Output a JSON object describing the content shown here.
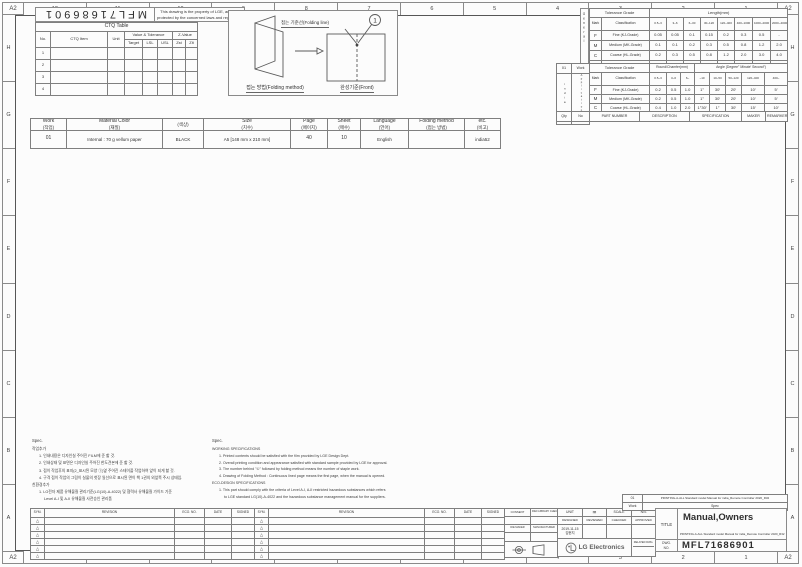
{
  "grid": {
    "corner_label": "A2",
    "top_columns": [
      "12",
      "11",
      "10",
      "9",
      "8",
      "7",
      "6",
      "5",
      "4",
      "3",
      "2",
      "1"
    ],
    "bottom_columns": [
      "12",
      "11",
      "10",
      "9",
      "8",
      "7",
      "6",
      "5",
      "4",
      "3",
      "2",
      "1"
    ],
    "left_rows": [
      "H",
      "G",
      "F",
      "E",
      "D",
      "C",
      "B",
      "A"
    ],
    "right_rows": [
      "H",
      "G",
      "F",
      "E",
      "D",
      "C",
      "B",
      "A"
    ]
  },
  "top_left": {
    "doc_number_rotated": "MFL71686901",
    "notice_line1": "This drawing is the property of LGE, and it is",
    "notice_line2": "protected by the concerned laws and regulation.",
    "ctq": {
      "title": "CTQ Table",
      "col_no": "No.",
      "col_item": "CTQ Item",
      "col_unit": "Unit",
      "col_vt": "Value & Tolerance",
      "col_z": "Z-Value",
      "sub_target": "Target",
      "sub_lsl": "LSL",
      "sub_usl": "USL",
      "sub_zst": "Zst",
      "sub_zlt": "Zlt",
      "rows": [
        "1",
        "2",
        "3",
        "4"
      ]
    }
  },
  "folding": {
    "line_label": "접는 기준선(Folding line)",
    "method_label": "접는 방법(Folding method)",
    "front_label": "완성기준(Front)",
    "callout": "1"
  },
  "tolerance": {
    "side_label_1": "General",
    "side_label_2": "Tolerance",
    "grade_header": "Tolerance Grade",
    "mark_header": "Mark",
    "class_header": "Classification",
    "length": {
      "header": "Length(mm)",
      "cols": [
        "0.5~3",
        "3~6",
        "6~30",
        "30~120",
        "120~400",
        "400~1000",
        "1000~2000",
        "2000~4000"
      ],
      "rows": [
        {
          "mark": "F",
          "name": "Fine (KJ-Grade)",
          "v": [
            "0.05",
            "0.05",
            "0.1",
            "0.15",
            "0.2",
            "0.3",
            "0.5",
            "-"
          ]
        },
        {
          "mark": "M",
          "name": "Medium (MK-Grade)",
          "v": [
            "0.1",
            "0.1",
            "0.2",
            "0.3",
            "0.5",
            "0.8",
            "1.2",
            "2.0"
          ]
        },
        {
          "mark": "C",
          "name": "Coarse (HL-Grade)",
          "v": [
            "0.2",
            "0.3",
            "0.5",
            "0.8",
            "1.2",
            "2.0",
            "3.0",
            "4.0"
          ]
        },
        {
          "mark": "Ⓥ",
          "name": "Very Coarse (HW-Grade)",
          "v": [
            "-",
            "0.5",
            "1.0",
            "1.5",
            "2.5",
            "4.0",
            "6.0",
            "8.0"
          ]
        }
      ]
    },
    "angle": {
      "header_round": "Round/Chamfer(mm)",
      "header_angle": "Angle (Degree° Minute′ Second″)",
      "cols": [
        "0.5~3",
        "3~6",
        "6~",
        "~10",
        "10~50",
        "50~120",
        "120~400",
        "400~"
      ],
      "rows": [
        {
          "mark": "F",
          "name": "Fine (KJ-Grade)",
          "v": [
            "0.2",
            "0.5",
            "1.0",
            "1°",
            "30′",
            "20′",
            "10′",
            "5′"
          ]
        },
        {
          "mark": "M",
          "name": "Medium (MK-Grade)",
          "v": [
            "0.2",
            "0.5",
            "1.0",
            "1°",
            "30′",
            "20′",
            "10′",
            "5′"
          ]
        },
        {
          "mark": "C",
          "name": "Coarse (HL-Grade)",
          "v": [
            "0.4",
            "1.0",
            "2.0",
            "1°30′",
            "1°",
            "30′",
            "15′",
            "10′"
          ]
        },
        {
          "mark": "Ⓥ",
          "name": "Very Coarse (HW-Grade)",
          "v": [
            "0.4",
            "1.0",
            "2.0",
            "3°",
            "2°",
            "1°",
            "30′",
            "20′"
          ]
        }
      ]
    },
    "side_boxes": {
      "work_no": "01",
      "work_label": "Work",
      "app_value": "india",
      "app_label": "Application",
      "site_value": "CW",
      "site_label": "Site",
      "qty_label": "Qty"
    },
    "parts_header": {
      "no": "No",
      "part_number": "PART NUMBER",
      "description": "DESCRIPTION",
      "specification": "SPECIFICATION",
      "maker": "MAKER",
      "remarker": "REMARKER"
    }
  },
  "work_table": {
    "cols": [
      {
        "label": "Work",
        "sub": "(작업)"
      },
      {
        "label": "Material Color",
        "sub": "(재질)"
      },
      {
        "label": "",
        "sub": "(색상)"
      },
      {
        "label": "Size",
        "sub": "(치수)"
      },
      {
        "label": "Page",
        "sub": "(페이지)"
      },
      {
        "label": "Sheet",
        "sub": "(매수)"
      },
      {
        "label": "Language",
        "sub": "(언어)"
      },
      {
        "label": "Folding method",
        "sub": "(접는 방법)"
      },
      {
        "label": "etc.",
        "sub": "(비고)"
      }
    ],
    "row": {
      "work": "01",
      "material": "Internal : 70 g vellum paper",
      "color": "BLACK",
      "size": "A5 [148 mm x 210 mm]",
      "page": "40",
      "sheet": "10",
      "language": "English",
      "folding": "",
      "etc": "india52"
    }
  },
  "notes_kr": {
    "title": "Spec.",
    "work_title": "작업추가",
    "items": [
      "1. 인쇄내용은 디자인실 주어진 FILM에 준 할 것.",
      "2. 인쇄상태 및 표면은 디자인실 주어진 한도견본에 준 할 것.",
      "3. 접이 작업후의 표지(2_표시된 모양 ①)옆 주어진 스테이플 작업하여 앞이 되게 할 것.",
      "4. 구격 접이 작업의 그림이 실물의 첫장 일선으로 표시된 면이 책 1권의 외앞쪽 주시 상태임."
    ],
    "eco_title": "친환경추가",
    "eco_items": [
      "1. LG전자 제품 유해물질 관리기준(LG(10)-A-4022) 및 협력사 유해물질 가이드 기준",
      "Level A-I 및 A-II 유해물질 사전승인 관리품"
    ]
  },
  "notes_en": {
    "title": "Spec.",
    "work_title": "WORKING SPECIFICATIONS",
    "items": [
      "1. Printed contents should be satisfied with the film provided by LGE Design Dept.",
      "2. Overall printing condition and appearance satisfied with standard sample provided by LGE for approval.",
      "3. The number behind \"①\" followed by folding method means the number of staple work.",
      "4. Drawing of Folding Method : Continuous lined page means the first page, when the manual is opened."
    ],
    "eco_title": "ECO-DESIGN SPECIFICATIONS",
    "eco_items": [
      "1. This part should comply with the criteria of Level A-I, A-II restricted hazardous substances which refers",
      "to LGE standard LG(10)-A-4022 and the hazardous substance management manual for the suppliers."
    ]
  },
  "revision": {
    "sym": "SYM.",
    "revision": "REVISION",
    "eco_no": "ECO. NO.",
    "date": "DATE",
    "signed": "SIGNED",
    "triangle": "△"
  },
  "title_block": {
    "consent": "CONSENT",
    "library": "R&D LIBRARY CHECKED",
    "die_maker": "DIE MAKER",
    "manufacturer": "MANUFACTURER",
    "unit_label": "UNIT",
    "unit_value": "㎜",
    "scale_label": "SCALE",
    "scale_value": "N/S",
    "designed": "DESIGNED",
    "reviewed": "REVIEWED",
    "checked": "CHECKED",
    "approved": "APPROVED",
    "design_date": "2019-11-15",
    "designer": "김현지",
    "brand": "LG Electronics",
    "related_dwg": "RELATED DWG.",
    "dwg_label_1": "DWG.",
    "dwg_label_2": "NO.",
    "dwg_no": "MFL71686901",
    "title_label": "TITLE",
    "title": "Manual,Owners",
    "subtitle": "PRINTING-A-ALL Standard model Manual for india_Remote Controller 2020_R32",
    "strip": {
      "work_no": "01",
      "work_label": "Work",
      "model": "PRINTING-A-ALL Standard model Manual for india_Remote Controller 2020_R32",
      "spec": "Spec"
    }
  }
}
